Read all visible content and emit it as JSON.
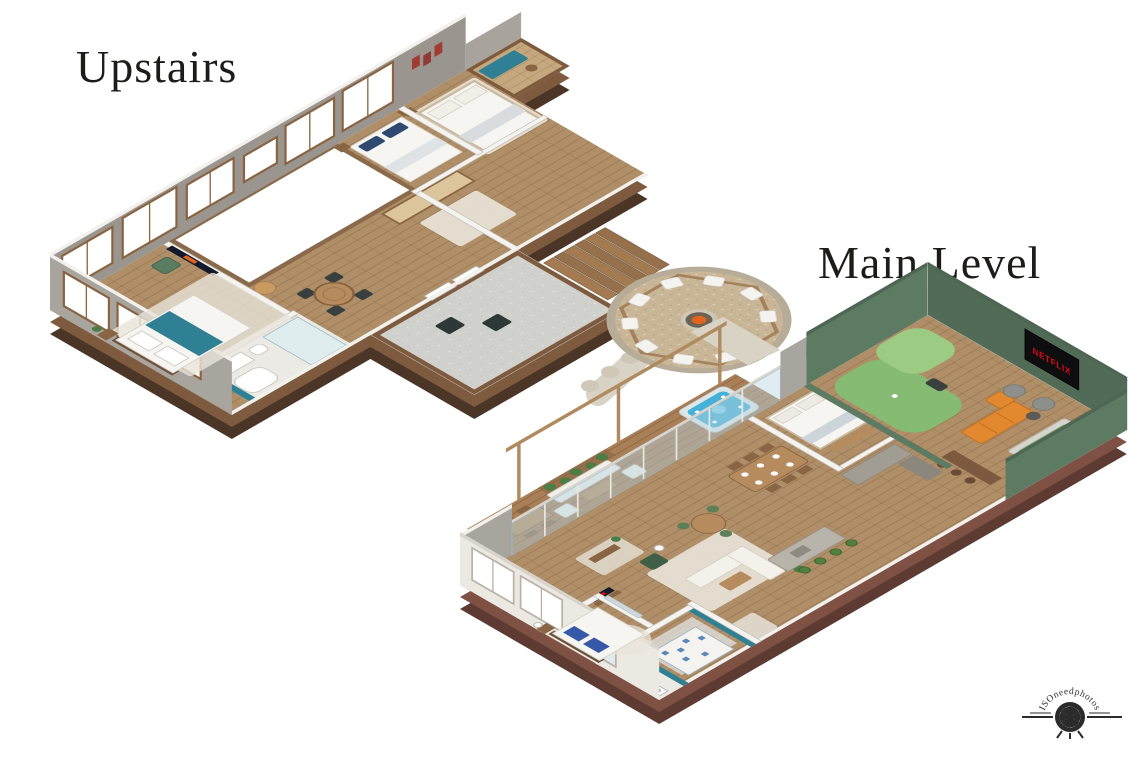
{
  "labels": {
    "upstairs": "Upstairs",
    "main_level": "Main Level"
  },
  "watermark": {
    "text": "ISOneedphotos"
  },
  "tv": {
    "brand": "NETFLIX",
    "screen_color": "#0e0e10",
    "brand_color": "#e50914"
  },
  "colors": {
    "background": "#ffffff",
    "title_text": "#1d1c1a",
    "wood_floor": "#b08f68",
    "wood_floor_light": "#c6a87e",
    "deck_wood": "#a97f57",
    "deck_concrete": "#d0d0cd",
    "wall_top": "#f2f1ed",
    "wall_gray": "#9a968f",
    "wood_trim": "#7e5b3e",
    "wood_dark": "#4a3526",
    "brick": "#7e5144",
    "brick_dark": "#5d3b32",
    "rug": "#e9e4da",
    "bed_white": "#f6f5f1",
    "teal_accent": "#2f7f95",
    "navy": "#2e4a70",
    "green_wall": "#5d7a63",
    "green_wall_dark": "#4e6754",
    "putting_green": "#85bb72",
    "putting_green_light": "#9ccb84",
    "orange_sofa": "#e2882e",
    "pool_felt": "#7fae71",
    "hot_tub": "#45b1d8",
    "patio_gravel": "#c9b697",
    "chair_white": "#f4f3ef",
    "fire": "#e2651b",
    "plant": "#4c7d45",
    "stone_path": "#d9d3c6",
    "driveway": "#6f6b64",
    "watermark_ink": "#1a1a1a"
  }
}
